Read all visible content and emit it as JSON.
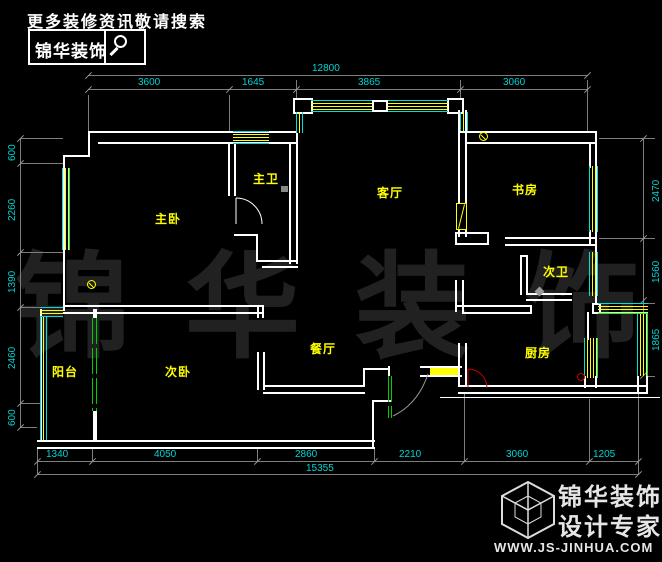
{
  "promo": {
    "tagline": "更多装修资讯敬请搜索",
    "brand": "锦华装饰",
    "search_icon": "magnifier"
  },
  "watermark": {
    "text": "锦华装饰"
  },
  "footer": {
    "logo_icon": "cube-wireframe",
    "brand": "锦华装饰",
    "subtitle": "设计专家",
    "website": "WWW.JS-JINHUA.COM"
  },
  "rooms": [
    {
      "id": "master-bedroom",
      "label": "主卧"
    },
    {
      "id": "master-bath",
      "label": "主卫"
    },
    {
      "id": "living-room",
      "label": "客厅"
    },
    {
      "id": "study",
      "label": "书房"
    },
    {
      "id": "second-bath",
      "label": "次卫"
    },
    {
      "id": "dining-room",
      "label": "餐厅"
    },
    {
      "id": "second-bedroom",
      "label": "次卧"
    },
    {
      "id": "balcony",
      "label": "阳台"
    },
    {
      "id": "kitchen",
      "label": "厨房"
    }
  ],
  "dims": {
    "top_total": "12800",
    "top": [
      "3600",
      "1645",
      "3865",
      "3060"
    ],
    "left": [
      "600",
      "2260",
      "1390",
      "2460",
      "600"
    ],
    "right": [
      "2470",
      "1560",
      "1865"
    ],
    "bottom": [
      "1340",
      "4050",
      "2860",
      "2210",
      "3060",
      "1205"
    ],
    "bottom_total": "15355"
  },
  "colors": {
    "wall": "#ffffff",
    "window_frame": "#00dede",
    "window_glass": "#ffff00",
    "dim_text": "#00d4d4",
    "dim_line": "#7d7d7d",
    "room_label": "#ffff00",
    "sliding_door": "#00cc00",
    "door_swing_red": "#cc0000",
    "background": "#000000"
  }
}
